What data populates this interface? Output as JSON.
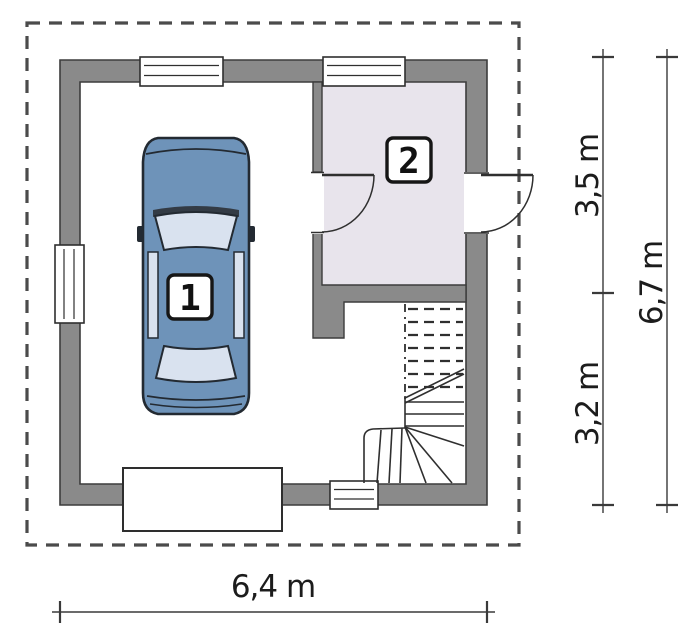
{
  "canvas": {
    "width": 700,
    "height": 636,
    "background": "#ffffff"
  },
  "plan": {
    "rooms": [
      {
        "number": "1"
      },
      {
        "number": "2"
      }
    ],
    "elements": [
      "roof-outline",
      "car",
      "winder-staircase",
      "garage-door",
      "entry-door",
      "interior-door",
      "window-top-left",
      "window-top-right",
      "window-left",
      "window-bottom"
    ]
  },
  "dimensions": {
    "right_upper": "3,5 m",
    "right_lower": "3,2 m",
    "right_total": "6,7 m",
    "bottom": "6,4 m"
  },
  "colors": {
    "wall_fill": "#8a8a8a",
    "wall_outline": "#3c3c3c",
    "room2_floor": "#e8e4ec",
    "roof_outline_dash": "#4b4b4b",
    "car_body": "#6e93b9",
    "car_glass": "#d9e2ef",
    "car_outline": "#232a32",
    "line_dark": "#2f2f2f",
    "dimension_line": "#3a3a3a",
    "dimension_text": "#1c1c1c"
  }
}
